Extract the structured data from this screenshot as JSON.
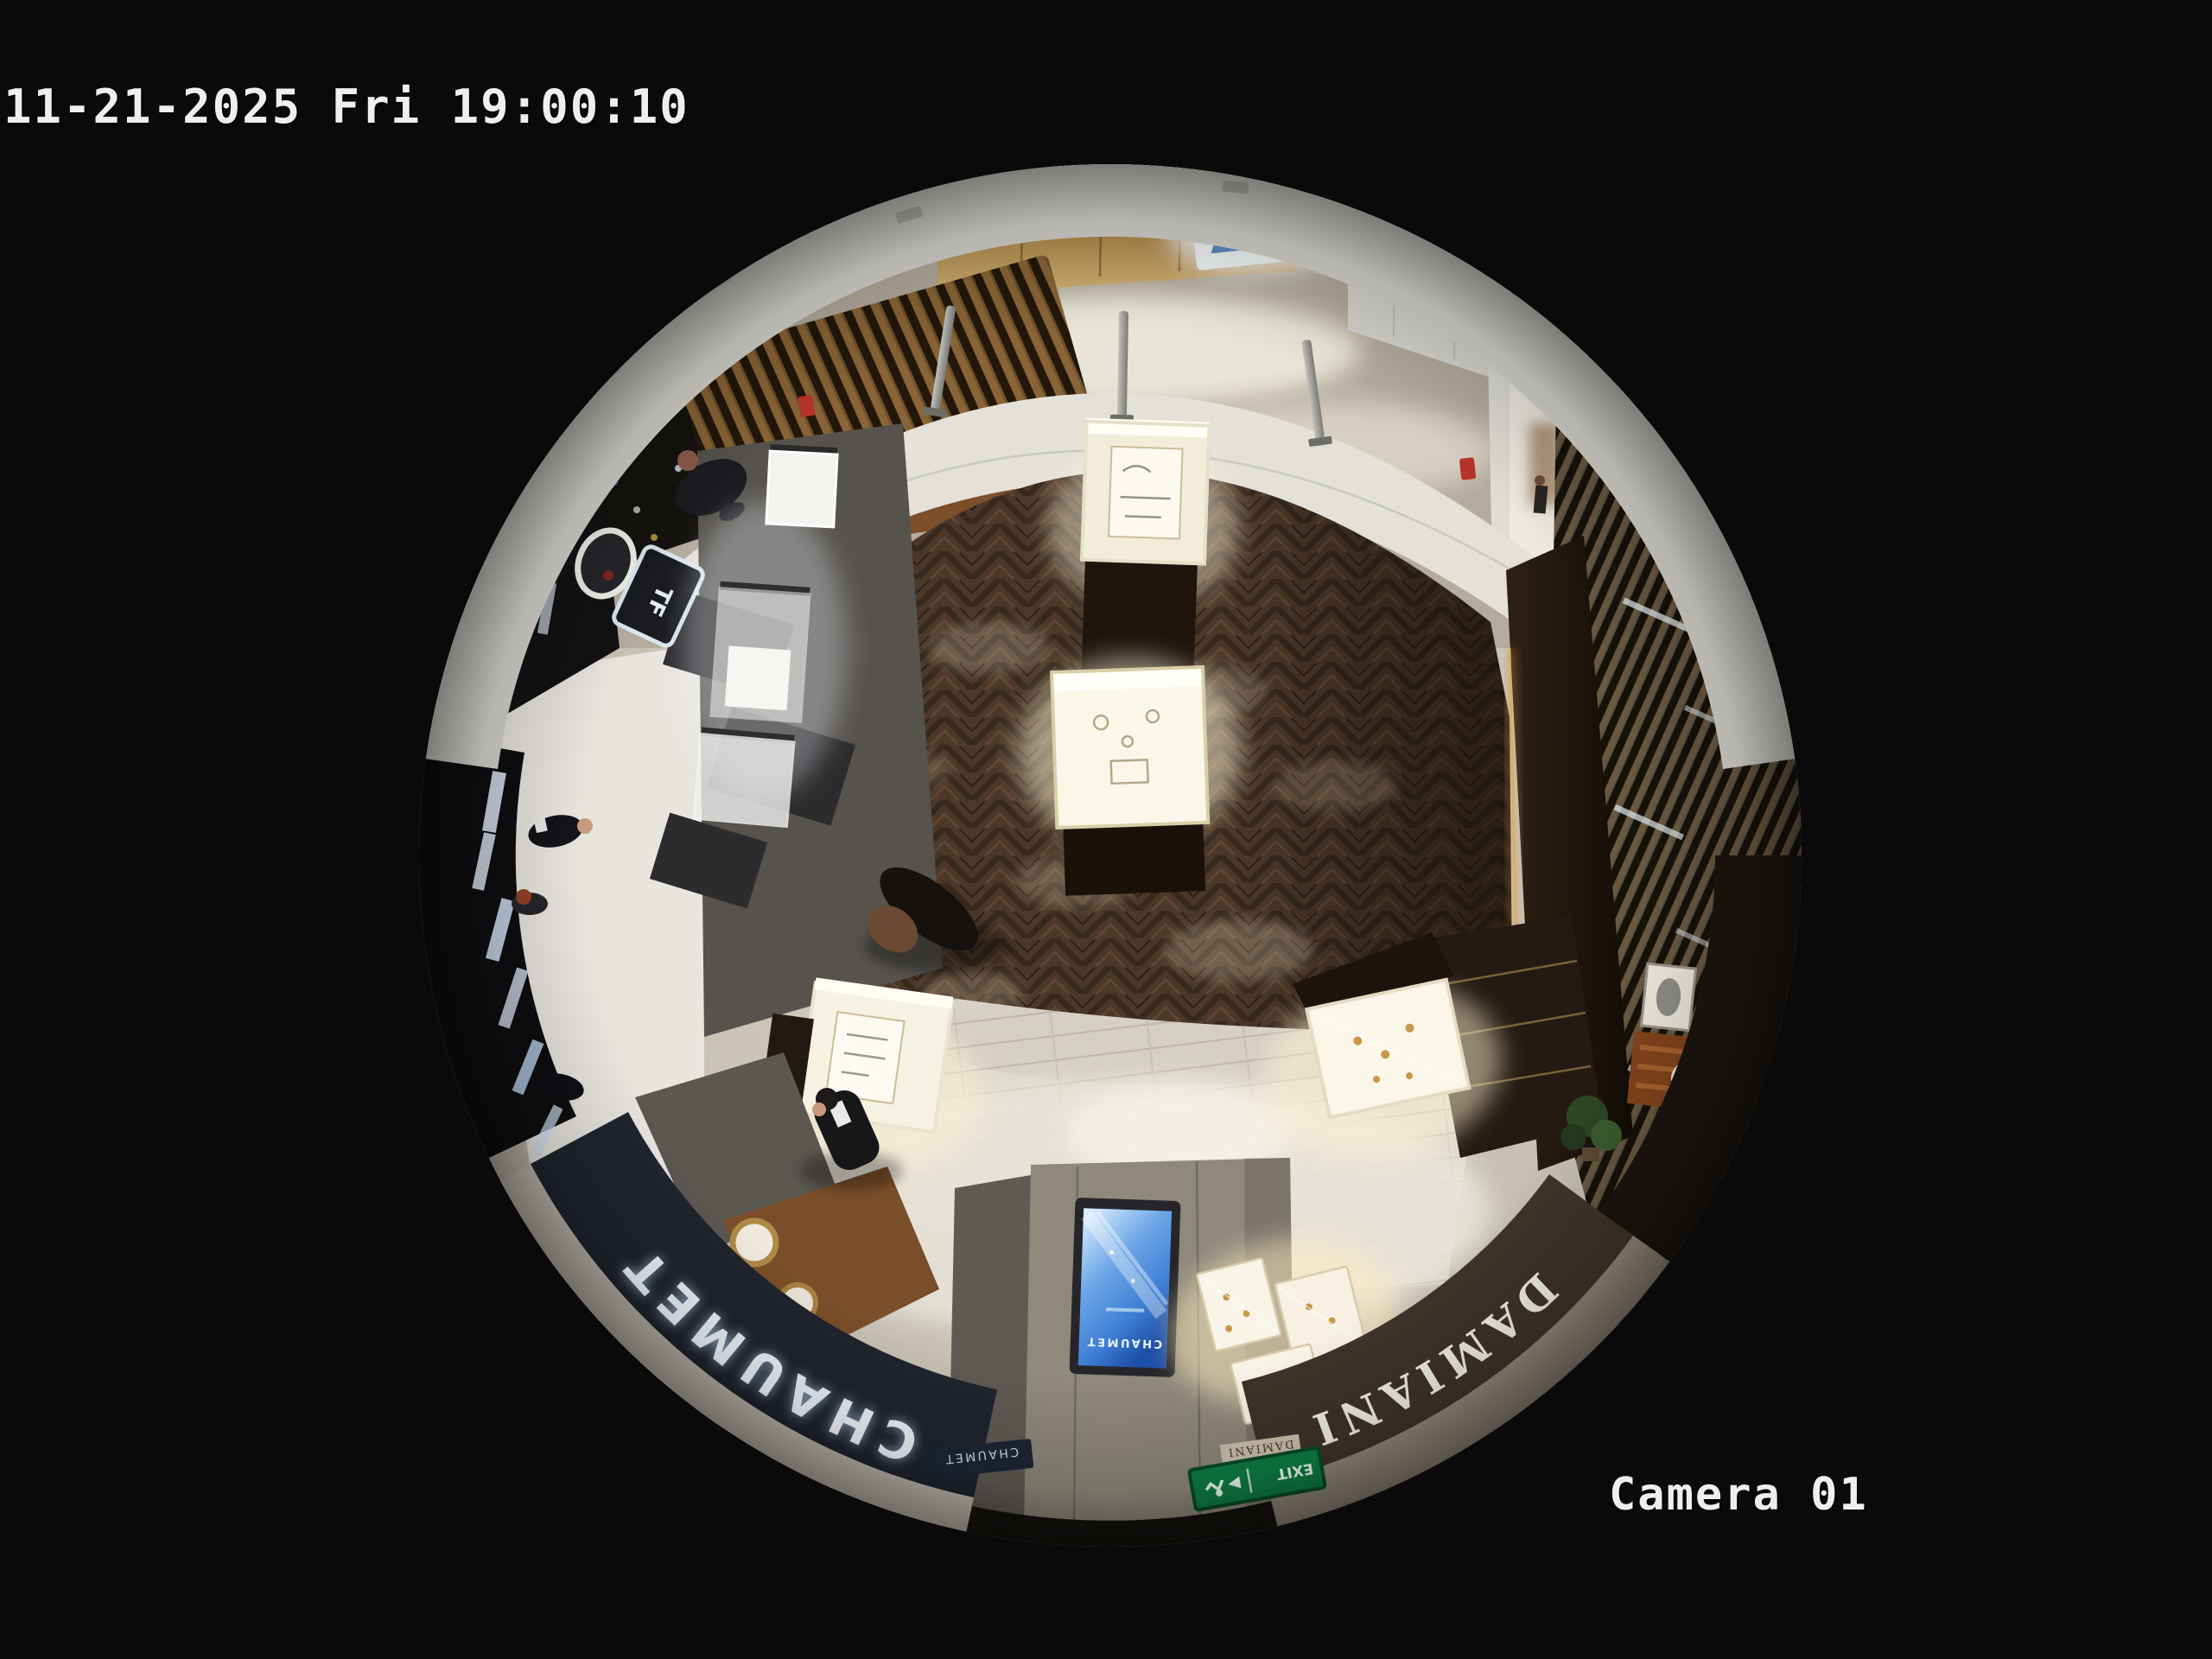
{
  "overlay": {
    "timestamp": "11-21-2025 Fri 19:00:10",
    "camera_label": "Camera 01"
  },
  "signage": {
    "tom_ford": "TOM FORD",
    "tf_monogram": "TF",
    "chaumet_fascia": "CHAUMET",
    "chaumet_screen": "CHAUMET",
    "chaumet_plaque": "CHAUMET",
    "damiani_fascia": "DAMIANI",
    "damiani_small": "DAMIANI",
    "gold_wall": "RONCH",
    "exit_sign": "EXIT"
  },
  "colors": {
    "background": "#0a0a0a",
    "overlay_text": "#efefef",
    "chaumet_fascia_bg": "#20242e",
    "damiani_fascia_bg": "#3f342a",
    "screen_blue": "#3f7fd6",
    "exit_green": "#0e8043",
    "led_amber": "#ffb763",
    "wood_floor": "#4c3828",
    "marble_walkway": "#c9c3b6"
  }
}
